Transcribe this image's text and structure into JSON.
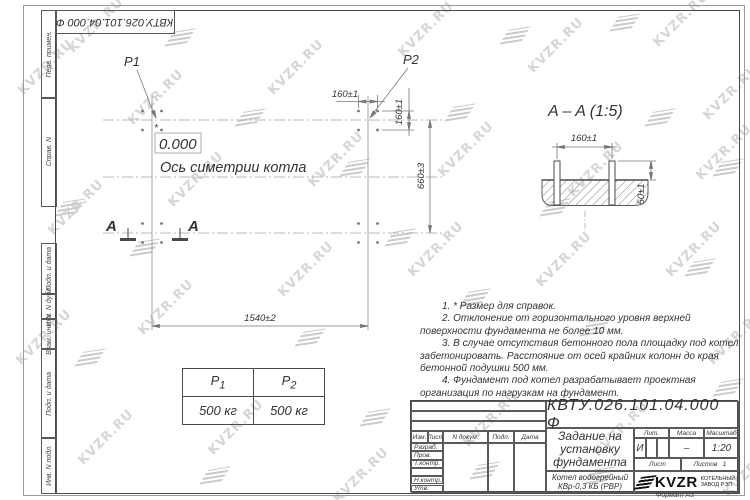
{
  "watermark": {
    "text": "KVZR.RU",
    "text_positions": [
      [
        10,
        60
      ],
      [
        120,
        90
      ],
      [
        260,
        60
      ],
      [
        390,
        22
      ],
      [
        520,
        38
      ],
      [
        645,
        12
      ],
      [
        695,
        85
      ],
      [
        40,
        200
      ],
      [
        160,
        172
      ],
      [
        300,
        152
      ],
      [
        430,
        142
      ],
      [
        560,
        162
      ],
      [
        688,
        145
      ],
      [
        8,
        330
      ],
      [
        130,
        300
      ],
      [
        270,
        262
      ],
      [
        400,
        242
      ],
      [
        528,
        252
      ],
      [
        658,
        242
      ],
      [
        70,
        430
      ],
      [
        200,
        420
      ],
      [
        325,
        468
      ],
      [
        455,
        412
      ],
      [
        585,
        422
      ],
      [
        700,
        330
      ],
      [
        715,
        462
      ],
      [
        60,
        18
      ]
    ],
    "icon_positions": [
      [
        170,
        30
      ],
      [
        240,
        110
      ],
      [
        345,
        160
      ],
      [
        300,
        330
      ],
      [
        450,
        105
      ],
      [
        465,
        290
      ],
      [
        390,
        230
      ],
      [
        545,
        200
      ],
      [
        585,
        320
      ],
      [
        650,
        110
      ],
      [
        690,
        260
      ],
      [
        615,
        15
      ],
      [
        718,
        160
      ],
      [
        60,
        200
      ],
      [
        80,
        350
      ],
      [
        205,
        468
      ],
      [
        475,
        463
      ],
      [
        590,
        468
      ],
      [
        718,
        380
      ],
      [
        505,
        28
      ],
      [
        365,
        410
      ],
      [
        135,
        240
      ]
    ]
  },
  "doc_number_top": "КВТУ.026.101.04.000  Ф",
  "margin_fields": {
    "perv": "Перв. примен.",
    "sprav": "Справ. N",
    "podp1": "Подп. и дата",
    "inv_dubl": "Инв. N дубл.",
    "vzam": "Взам. инв. N",
    "podp2": "Подп. и дата",
    "inv_podl": "Инв. N подл."
  },
  "plan": {
    "p1": "P1",
    "p2": "P2",
    "zero": "0.000",
    "asterisk": "*",
    "axis_label": "Ось симетрии котла",
    "dim_160_top": "160±1",
    "dim_160_side": "160±1",
    "dim_660": "660±3",
    "dim_1540": "1540±2",
    "section_letter_left": "A",
    "section_letter_right": "A"
  },
  "section": {
    "title": "A – A (1:5)",
    "dim_160": "160±1",
    "dim_50": "50±1"
  },
  "notes": {
    "items": [
      "1. * Размер для справок.",
      "2. Отклонение от горизонтального уровня верхней поверхности фундамента не более 10 мм.",
      "3. В случае отсутствия бетонного пола площадку под котел забетонировать. Расстояние от осей крайних колонн до края бетонной подушки 500 мм.",
      "4. Фундамент под котел разрабатывает проектная организация по нагрузкам на фундамент."
    ]
  },
  "loads_table": {
    "p1": {
      "name": "P",
      "sub": "1",
      "value": "500 кг"
    },
    "p2": {
      "name": "P",
      "sub": "2",
      "value": "500 кг"
    }
  },
  "title_block": {
    "doc_number": "КВТУ.026.101.04.000  Ф",
    "title": [
      "Задание на",
      "установку",
      "фундамента"
    ],
    "product": [
      "Котел водогрейный",
      "КВр-0,3 КБ (РВР)"
    ],
    "header": {
      "izm": "Изм.",
      "list": "Лист",
      "doc": "N докум.",
      "podp": "Подп.",
      "data": "Дата"
    },
    "rows": [
      "Разраб.",
      "Пров.",
      "Т.контр.",
      "",
      "Н.контр.",
      "Утв."
    ],
    "lit_label": "Лит.",
    "mass_label": "Масса",
    "scale_label": "Масштаб",
    "lit_value": "И",
    "mass_value": "–",
    "scale_value": "1:20",
    "sheet_label": "Лист",
    "sheets_label": "Листов",
    "sheets_value": "1",
    "company": {
      "name": "KVZR",
      "line1": "КОТЕЛЬНЫЙ",
      "line2": "ЗАВОД РЭП"
    },
    "format": "Формат А3"
  }
}
